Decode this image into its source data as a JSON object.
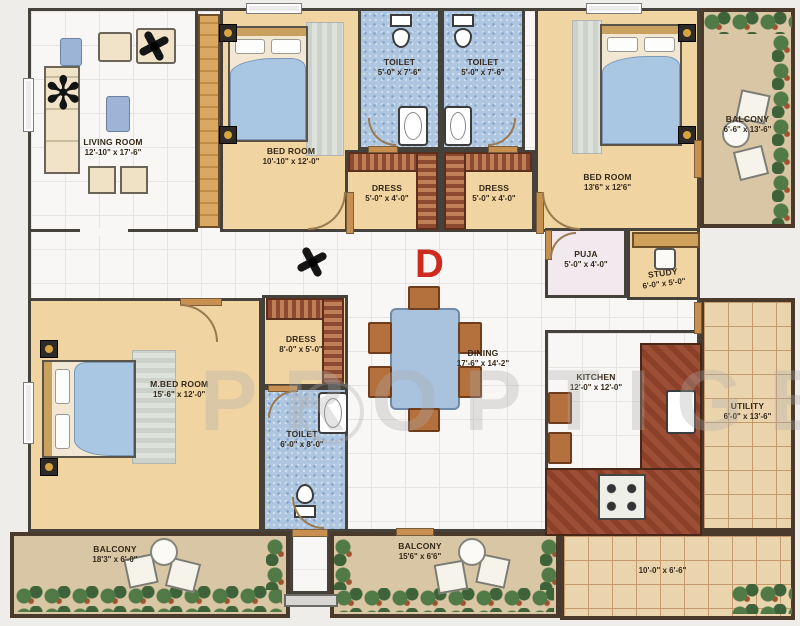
{
  "watermark": "PROPTIGER",
  "plan_mark": "D",
  "colors": {
    "wall": "#45413b",
    "bedroom_floor": "#f0d4a2",
    "toilet_floor": "#aec6e0",
    "balcony_floor": "#d9c6a4",
    "utility_tile": "#ead4ae",
    "counter": "#9c4f35",
    "bed_linen": "#a9c6e2",
    "plan_letter_red": "#cf2a1e"
  },
  "rooms": {
    "living": {
      "name": "LIVING ROOM",
      "dim": "12'-10\" x 17'-6\""
    },
    "bed1": {
      "name": "BED ROOM",
      "dim": "10'-10\" x 12'-0\""
    },
    "toilet1": {
      "name": "TOILET",
      "dim": "5'-0\" x 7'-6\""
    },
    "toilet2": {
      "name": "TOILET",
      "dim": "5'-0\" x 7'-6\""
    },
    "dress1": {
      "name": "DRESS",
      "dim": "5'-0\" x 4'-0\""
    },
    "dress2": {
      "name": "DRESS",
      "dim": "5'-0\" x 4'-0\""
    },
    "bed2": {
      "name": "BED ROOM",
      "dim": "13'6\" x 12'6\""
    },
    "balcony_tr": {
      "name": "BALCONY",
      "dim": "6'-6\" x 13'-6\""
    },
    "puja": {
      "name": "PUJA",
      "dim": "5'-0\" x 4'-0\""
    },
    "study": {
      "name": "STUDY",
      "dim": "6'-0\" x 5'-0\""
    },
    "mbed": {
      "name": "M.BED ROOM",
      "dim": "15'-6\" x 12'-0\""
    },
    "dress3": {
      "name": "DRESS",
      "dim": "8'-0\" x 5'-0\""
    },
    "toilet3": {
      "name": "TOILET",
      "dim": "6'-0\" x 8'-0\""
    },
    "dining": {
      "name": "DINING",
      "dim": "17'-6\" x 14'-2\""
    },
    "kitchen": {
      "name": "KITCHEN",
      "dim": "12'-0\" x 12'-0\""
    },
    "utility": {
      "name": "UTILITY",
      "dim": "6'-0\" x 13'-6\""
    },
    "balcony_bl": {
      "name": "BALCONY",
      "dim": "18'3\" x 6'-0\""
    },
    "balcony_bm": {
      "name": "BALCONY",
      "dim": "15'6\" x 6'6\""
    },
    "terrace": {
      "name": "",
      "dim": "10'-0\" x 6'-6\""
    }
  }
}
